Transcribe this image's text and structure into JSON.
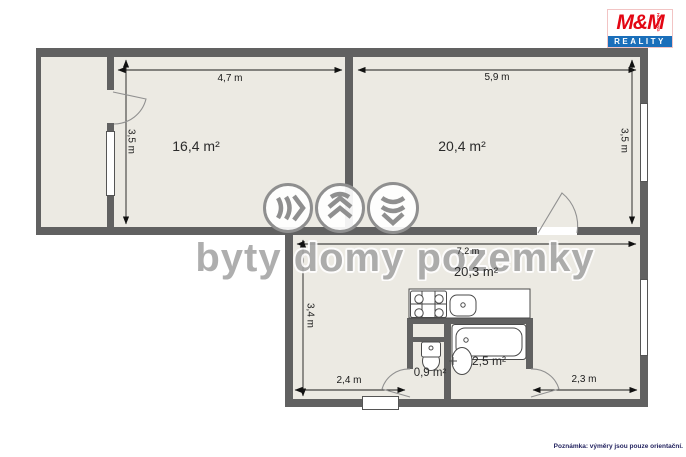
{
  "watermark": {
    "text": "byty domy pozemky"
  },
  "logo": {
    "mm": "M&M",
    "holding": "HOLDING",
    "reality": "REALITY"
  },
  "note": "Poznámka: výměry jsou pouze orientační.",
  "rooms": {
    "room1": {
      "area": "16,4 m²",
      "width": "4,7 m",
      "height": "3,5 m"
    },
    "room2": {
      "area": "20,4 m²",
      "width": "5,9 m",
      "height": "3,5 m"
    },
    "living": {
      "area": "20,3 m²",
      "width": "7,2 m",
      "height": "3,4 m",
      "left_width": "2,4 m",
      "right_width": "2,3 m"
    },
    "wc": {
      "area": "0,9 m²"
    },
    "bathroom": {
      "area": "2,5 m²"
    }
  },
  "colors": {
    "wall": "#616161",
    "floor": "#ECEAE3",
    "dimension": "#1A1A1A",
    "watermark_grey": "#A6A6A6",
    "logo_red": "#E30613",
    "logo_blue": "#1A6FBA"
  }
}
